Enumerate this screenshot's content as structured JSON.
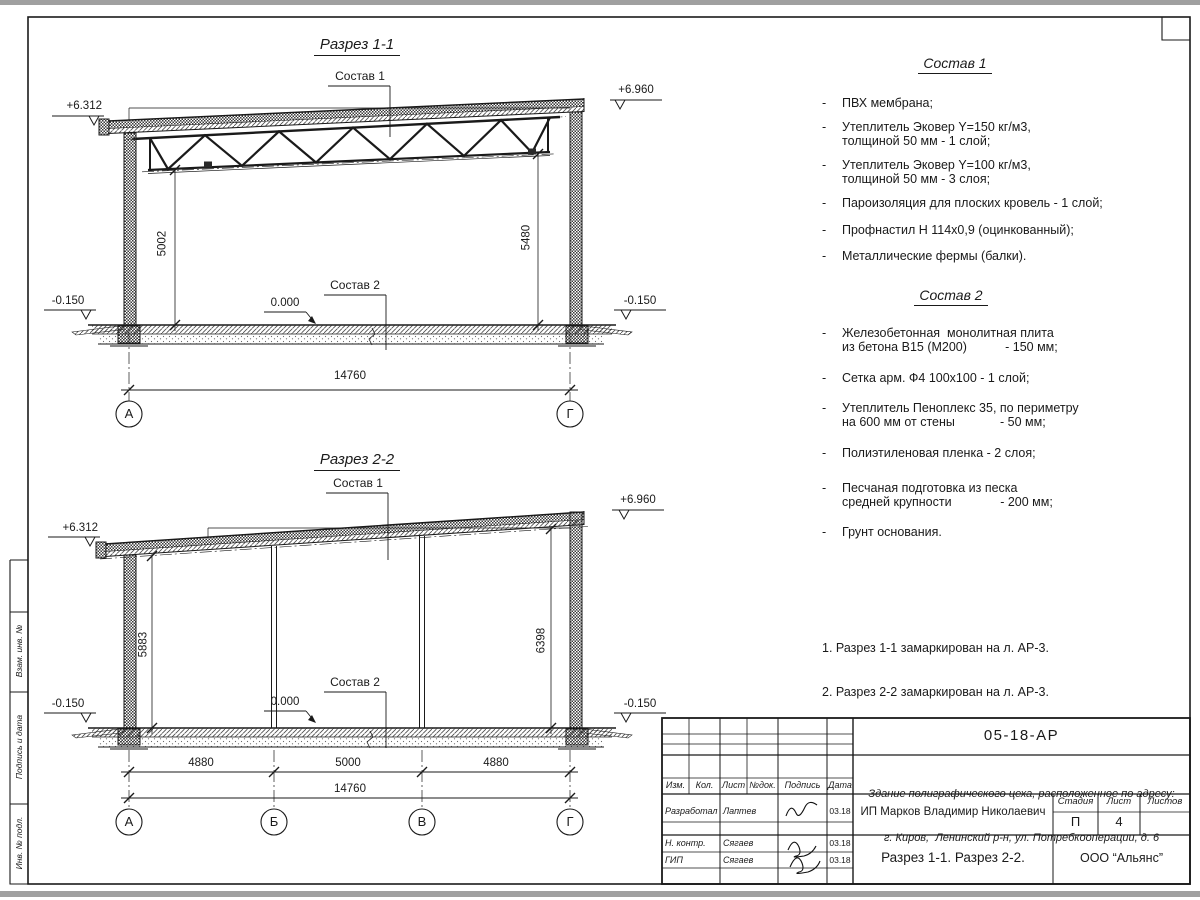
{
  "section1": {
    "title": "Разрез 1-1",
    "sostav1_label": "Состав 1",
    "sostav2_label": "Состав 2",
    "elev_top_left": "+6.312",
    "elev_top_right": "+6.960",
    "elev_zero": "0.000",
    "elev_bottom_left": "-0.150",
    "elev_bottom_right": "-0.150",
    "dim_height_left": "5002",
    "dim_height_right": "5480",
    "dim_total": "14760",
    "axes": [
      "А",
      "Г"
    ]
  },
  "section2": {
    "title": "Разрез 2-2",
    "sostav1_label": "Состав 1",
    "sostav2_label": "Состав 2",
    "elev_top_left": "+6.312",
    "elev_top_right": "+6.960",
    "elev_zero": "0.000",
    "elev_bottom_left": "-0.150",
    "elev_bottom_right": "-0.150",
    "dim_height_left": "5883",
    "dim_height_right": "6398",
    "dim_spans": [
      "4880",
      "5000",
      "4880"
    ],
    "dim_total": "14760",
    "axes": [
      "А",
      "Б",
      "В",
      "Г"
    ]
  },
  "sostav1": {
    "title": "Состав 1",
    "bullet": "-",
    "items": [
      "ПВХ мембрана;",
      "Утеплитель Эковер Y=150 кг/м3,\nтолщиной 50 мм - 1 слой;",
      "Утеплитель Эковер Y=100 кг/м3,\nтолщиной 50 мм - 3 слоя;",
      "Пароизоляция для плоских кровель - 1 слой;",
      "Профнастил Н 114х0,9 (оцинкованный);",
      "Металлические фермы (балки)."
    ]
  },
  "sostav2": {
    "title": "Состав 2",
    "bullet": "-",
    "items": [
      "Железобетонная  монолитная плита\nиз бетона В15 (М200)           - 150 мм;",
      "Сетка арм. Ф4 100х100 - 1 слой;",
      "Утеплитель Пеноплекс 35, по периметру\nна 600 мм от стены             - 50 мм;",
      "Полиэтиленовая пленка - 2 слоя;",
      "Песчаная подготовка из песка\nсредней крупности              - 200 мм;",
      "Грунт основания."
    ]
  },
  "notes": {
    "lines": [
      "1. Разрез 1-1 замаркирован на л. АР-3.",
      "2. Разрез 2-2 замаркирован на л. АР-3."
    ]
  },
  "side_column": {
    "labels": [
      "Взам. инв. №",
      "Подпись и дата",
      "Инв. № подл."
    ]
  },
  "titleblock": {
    "doc_code": "05-18-АР",
    "object_line1": "Здание полиграфического цеха, расположенное по адресу:",
    "object_line2": "г. Киров,  Ленинский р-н, ул. Потребкооперации, д. 6",
    "client": "ИП Марков Владимир Николаевич",
    "sheet_title": "Разрез 1-1. Разрез 2-2.",
    "company": "ООО “Альянс”",
    "stage_label": "Стадия",
    "sheet_label": "Лист",
    "sheets_label": "Листов",
    "stage": "П",
    "sheet": "4",
    "sheets": "",
    "cols": [
      "Изм.",
      "Кол.",
      "Лист",
      "№док.",
      "Подпись",
      "Дата"
    ],
    "rows": [
      {
        "role": "Разработал",
        "name": "Лаптев",
        "date": "03.18"
      },
      {
        "role": "Н. контр.",
        "name": "Сягаев",
        "date": "03.18"
      },
      {
        "role": "ГИП",
        "name": "Сягаев",
        "date": "03.18"
      }
    ]
  }
}
